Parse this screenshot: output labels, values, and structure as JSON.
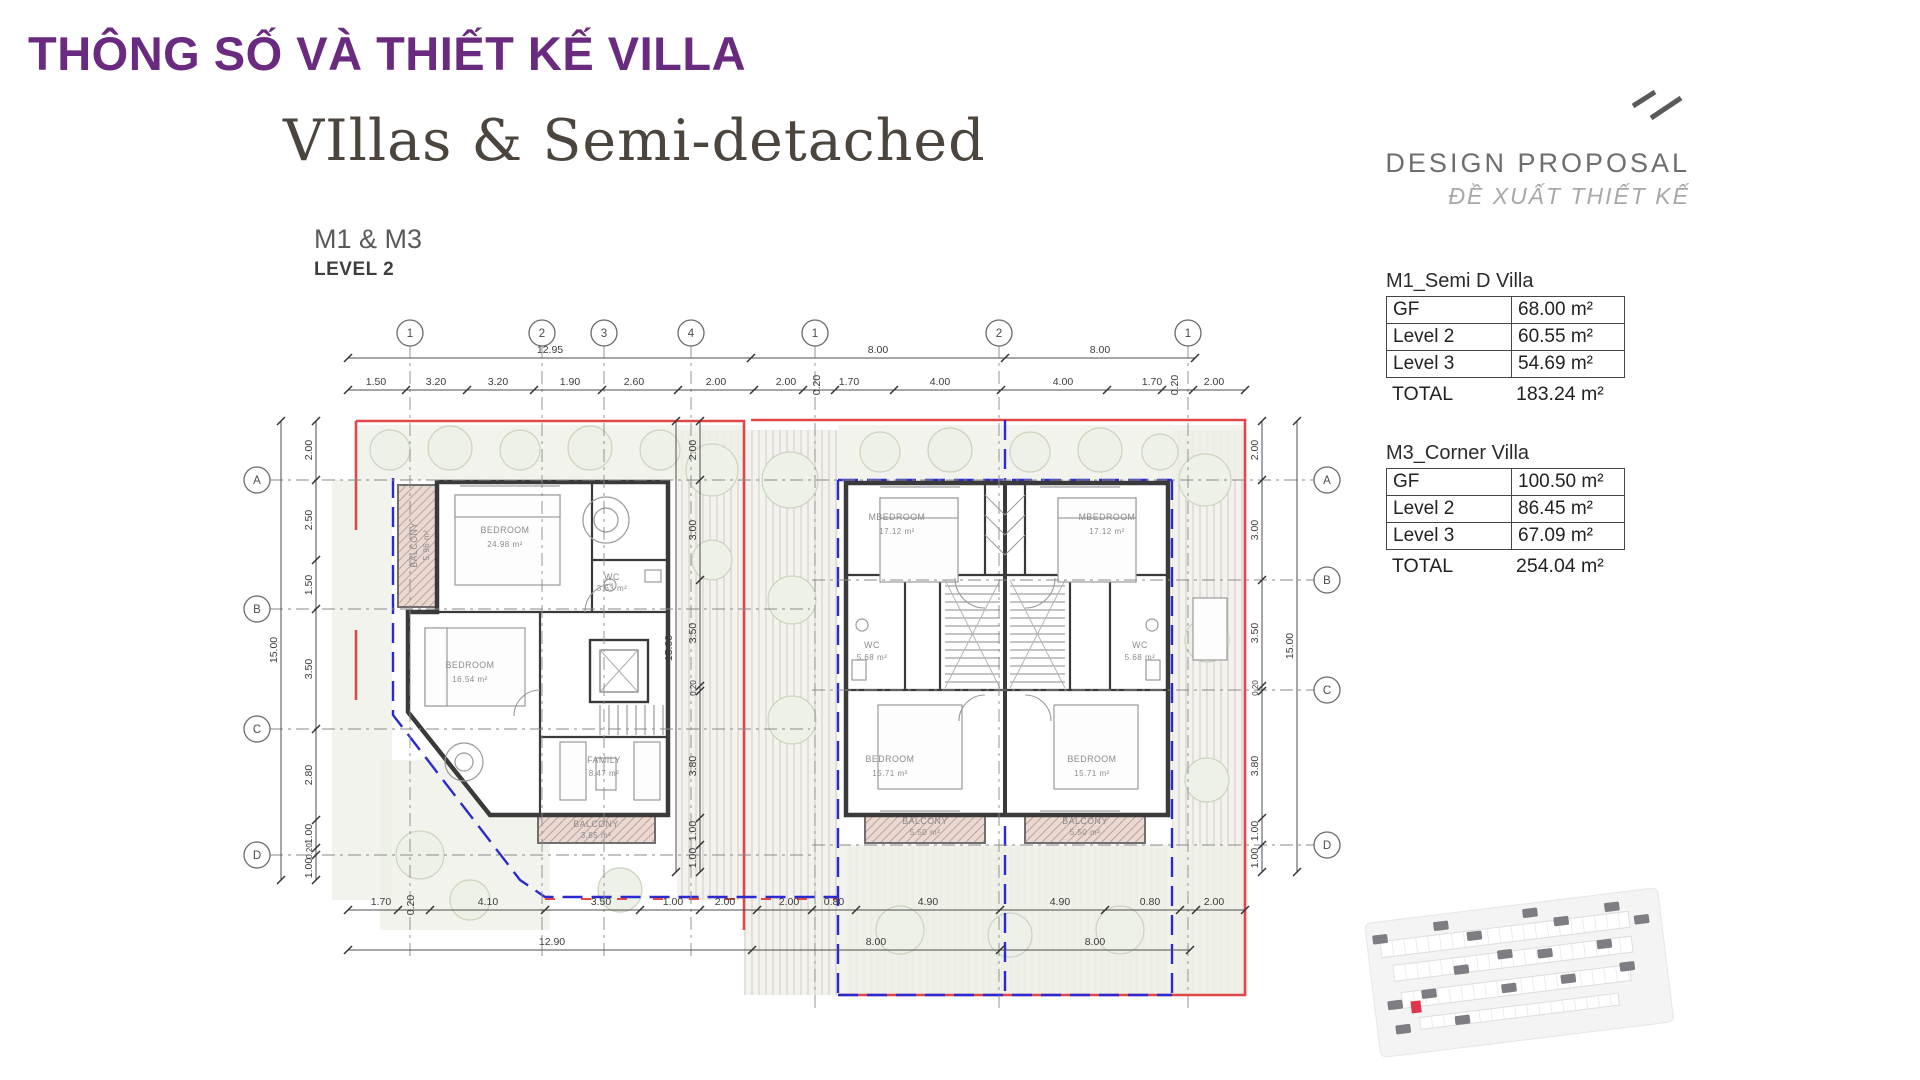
{
  "header": {
    "title": "THÔNG SỐ VÀ THIẾT KẾ VILLA",
    "heading": "VIllas & Semi-detached",
    "models": "M1 & M3",
    "level": "LEVEL 2"
  },
  "proposal": {
    "title": "DESIGN PROPOSAL",
    "subtitle": "ĐỀ XUẤT THIẾT KẾ"
  },
  "tables": [
    {
      "title": "M1_Semi D Villa",
      "rows": [
        {
          "label": "GF",
          "value": "68.00 m²"
        },
        {
          "label": "Level 2",
          "value": "60.55 m²"
        },
        {
          "label": "Level 3",
          "value": "54.69 m²"
        }
      ],
      "total_label": "TOTAL",
      "total_value": "183.24 m²"
    },
    {
      "title": "M3_Corner Villa",
      "rows": [
        {
          "label": "GF",
          "value": "100.50 m²"
        },
        {
          "label": "Level 2",
          "value": "86.45 m²"
        },
        {
          "label": "Level 3",
          "value": "67.09 m²"
        }
      ],
      "total_label": "TOTAL",
      "total_value": "254.04 m²"
    }
  ],
  "colors": {
    "accent_purple": "#692a80",
    "lot_red": "#e04848",
    "lot_blue": "#2a2ad0"
  },
  "plan": {
    "grid_circles": [
      {
        "t": "1",
        "x": 410,
        "y": 333
      },
      {
        "t": "2",
        "x": 542,
        "y": 333
      },
      {
        "t": "3",
        "x": 604,
        "y": 333
      },
      {
        "t": "4",
        "x": 691,
        "y": 333
      },
      {
        "t": "1",
        "x": 815,
        "y": 333
      },
      {
        "t": "2",
        "x": 999,
        "y": 333
      },
      {
        "t": "1",
        "x": 1188,
        "y": 333
      },
      {
        "t": "A",
        "x": 257,
        "y": 480
      },
      {
        "t": "B",
        "x": 257,
        "y": 609
      },
      {
        "t": "C",
        "x": 257,
        "y": 729
      },
      {
        "t": "D",
        "x": 257,
        "y": 855
      },
      {
        "t": "A",
        "x": 1327,
        "y": 480
      },
      {
        "t": "B",
        "x": 1327,
        "y": 580
      },
      {
        "t": "C",
        "x": 1327,
        "y": 690
      },
      {
        "t": "D",
        "x": 1327,
        "y": 845
      }
    ],
    "dim_rows": [
      {
        "y": 358,
        "x1": 348,
        "x2": 1195,
        "ticks": [
          348,
          751,
          1005,
          1195
        ],
        "labels": [
          {
            "t": "12.95",
            "x": 550
          },
          {
            "t": "8.00",
            "x": 878
          },
          {
            "t": "8.00",
            "x": 1100
          }
        ]
      },
      {
        "y": 390,
        "x1": 348,
        "x2": 1245,
        "ticks": [
          348,
          406,
          467,
          534,
          602,
          678,
          754,
          803,
          835,
          894,
          1001,
          1107,
          1162,
          1193,
          1245
        ],
        "labels": [
          {
            "t": "1.50",
            "x": 376
          },
          {
            "t": "3.20",
            "x": 436
          },
          {
            "t": "3.20",
            "x": 498
          },
          {
            "t": "1.90",
            "x": 570
          },
          {
            "t": "2.60",
            "x": 634
          },
          {
            "t": "2.00",
            "x": 716
          },
          {
            "t": "2.00",
            "x": 786
          },
          {
            "t": "0.20",
            "x": 820,
            "r": 1
          },
          {
            "t": "1.70",
            "x": 849
          },
          {
            "t": "4.00",
            "x": 940
          },
          {
            "t": "4.00",
            "x": 1063
          },
          {
            "t": "1.70",
            "x": 1152
          },
          {
            "t": "0.20",
            "x": 1178,
            "r": 1
          },
          {
            "t": "2.00",
            "x": 1214
          }
        ]
      },
      {
        "y": 910,
        "x1": 348,
        "x2": 1245,
        "ticks": [
          348,
          398,
          430,
          545,
          640,
          700,
          757,
          812,
          856,
          1000,
          1105,
          1180,
          1196,
          1245
        ],
        "labels": [
          {
            "t": "1.70",
            "x": 381
          },
          {
            "t": "0.20",
            "x": 414,
            "r": 1
          },
          {
            "t": "4.10",
            "x": 488
          },
          {
            "t": "3.50",
            "x": 601
          },
          {
            "t": "1.00",
            "x": 673
          },
          {
            "t": "2.00",
            "x": 725
          },
          {
            "t": "2.00",
            "x": 789
          },
          {
            "t": "0.80",
            "x": 834
          },
          {
            "t": "4.90",
            "x": 928
          },
          {
            "t": "4.90",
            "x": 1060
          },
          {
            "t": "0.80",
            "x": 1150
          },
          {
            "t": "2.00",
            "x": 1214
          }
        ]
      },
      {
        "y": 950,
        "x1": 348,
        "x2": 1190,
        "ticks": [
          348,
          752,
          1000,
          1190
        ],
        "labels": [
          {
            "t": "12.90",
            "x": 552
          },
          {
            "t": "8.00",
            "x": 876
          },
          {
            "t": "8.00",
            "x": 1095
          }
        ]
      }
    ],
    "dim_cols": [
      {
        "x": 281,
        "y1": 421,
        "y2": 880,
        "ticks": [
          421,
          880
        ],
        "labels": [
          {
            "t": "15.00",
            "y": 650
          }
        ]
      },
      {
        "x": 316,
        "y1": 421,
        "y2": 880,
        "ticks": [
          421,
          480,
          560,
          609,
          729,
          820,
          848,
          855,
          880
        ],
        "labels": [
          {
            "t": "2.00",
            "y": 450
          },
          {
            "t": "2.50",
            "y": 520
          },
          {
            "t": "1.50",
            "y": 585
          },
          {
            "t": "3.50",
            "y": 669
          },
          {
            "t": "2.80",
            "y": 775
          },
          {
            "t": "1.00",
            "y": 834
          },
          {
            "t": "0.20",
            "y": 851,
            "s": 1
          },
          {
            "t": "1.00",
            "y": 868
          }
        ]
      },
      {
        "x": 700,
        "y1": 421,
        "y2": 872,
        "ticks": [
          421,
          480,
          580,
          686,
          691,
          818,
          845,
          872
        ],
        "labels": [
          {
            "t": "2.00",
            "y": 450
          },
          {
            "t": "3.00",
            "y": 530
          },
          {
            "t": "3.50",
            "y": 633
          },
          {
            "t": "0.20",
            "y": 688,
            "s": 1
          },
          {
            "t": "3.80",
            "y": 766
          },
          {
            "t": "1.00",
            "y": 831
          },
          {
            "t": "1.00",
            "y": 858
          }
        ]
      },
      {
        "x": 676,
        "y1": 421,
        "y2": 872,
        "ticks": [
          421,
          872
        ],
        "labels": [
          {
            "t": "15.00",
            "y": 648
          }
        ]
      },
      {
        "x": 1262,
        "y1": 421,
        "y2": 872,
        "ticks": [
          421,
          480,
          580,
          686,
          691,
          818,
          845,
          872
        ],
        "labels": [
          {
            "t": "2.00",
            "y": 450
          },
          {
            "t": "3.00",
            "y": 530
          },
          {
            "t": "3.50",
            "y": 633
          },
          {
            "t": "0.20",
            "y": 688,
            "s": 1
          },
          {
            "t": "3.80",
            "y": 766
          },
          {
            "t": "1.00",
            "y": 831
          },
          {
            "t": "1.00",
            "y": 858
          }
        ]
      },
      {
        "x": 1297,
        "y1": 421,
        "y2": 872,
        "ticks": [
          421,
          872
        ],
        "labels": [
          {
            "t": "15.00",
            "y": 646
          }
        ]
      }
    ],
    "room_labels": [
      {
        "t": "BEDROOM",
        "x": 505,
        "y": 533
      },
      {
        "t": "24.98 m²",
        "x": 505,
        "y": 547,
        "s": 1
      },
      {
        "t": "BEDROOM",
        "x": 470,
        "y": 668
      },
      {
        "t": "16.54 m²",
        "x": 470,
        "y": 682,
        "s": 1
      },
      {
        "t": "FAMILY",
        "x": 604,
        "y": 763
      },
      {
        "t": "8.47 m²",
        "x": 604,
        "y": 776,
        "s": 1
      },
      {
        "t": "BALCONY",
        "x": 417,
        "y": 545,
        "r": 1
      },
      {
        "t": "5.96 m²",
        "x": 429,
        "y": 545,
        "r": 1,
        "s": 1
      },
      {
        "t": "BALCONY",
        "x": 596,
        "y": 827
      },
      {
        "t": "3.85 m²",
        "x": 596,
        "y": 838,
        "s": 1
      },
      {
        "t": "WC",
        "x": 612,
        "y": 580
      },
      {
        "t": "3.63 m²",
        "x": 612,
        "y": 591,
        "s": 1
      },
      {
        "t": "MBEDROOM",
        "x": 897,
        "y": 520
      },
      {
        "t": "17.12 m²",
        "x": 897,
        "y": 534,
        "s": 1
      },
      {
        "t": "MBEDROOM",
        "x": 1107,
        "y": 520
      },
      {
        "t": "17.12 m²",
        "x": 1107,
        "y": 534,
        "s": 1
      },
      {
        "t": "WC",
        "x": 872,
        "y": 648
      },
      {
        "t": "5.68 m²",
        "x": 872,
        "y": 660,
        "s": 1
      },
      {
        "t": "WC",
        "x": 1140,
        "y": 648
      },
      {
        "t": "5.68 m²",
        "x": 1140,
        "y": 660,
        "s": 1
      },
      {
        "t": "BEDROOM",
        "x": 890,
        "y": 762
      },
      {
        "t": "15.71 m²",
        "x": 890,
        "y": 776,
        "s": 1
      },
      {
        "t": "BEDROOM",
        "x": 1092,
        "y": 762
      },
      {
        "t": "15.71 m²",
        "x": 1092,
        "y": 776,
        "s": 1
      },
      {
        "t": "BALCONY",
        "x": 925,
        "y": 824
      },
      {
        "t": "5.50 m²",
        "x": 925,
        "y": 835,
        "s": 1
      },
      {
        "t": "BALCONY",
        "x": 1085,
        "y": 824
      },
      {
        "t": "5.50 m²",
        "x": 1085,
        "y": 835,
        "s": 1
      }
    ]
  }
}
